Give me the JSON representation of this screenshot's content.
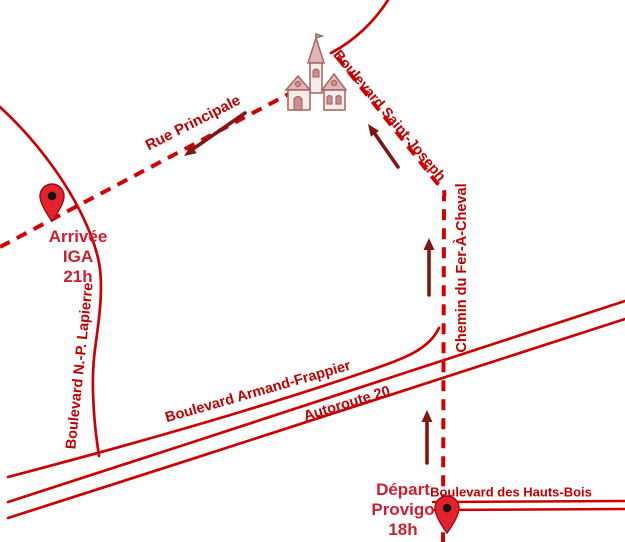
{
  "colors": {
    "background": "#FFFFFF",
    "road_red": "#CC0000",
    "route_red": "#D40000",
    "label_red": "#C00000",
    "marker_text_red": "#CE1F2F",
    "arrow_dark_red": "#801616",
    "pin_red": "#E6212E",
    "pin_stroke": "#8B0E14",
    "pin_dot": "#111111",
    "church_rose": "#A96A6A",
    "church_roof_fill": "#DEB8B8",
    "church_wall_fill": "#F6ECEC",
    "church_window_fill": "#C98F8F"
  },
  "roads": {
    "rue_principale": "Rue Principale",
    "saint_joseph": "Boulevard Saint-Joseph",
    "fer_a_cheval": "Chemin du Fer-À-Cheval",
    "lapierre": "Boulevard N.-P. Lapierre",
    "armand_frappier": "Boulevard Armand-Frappier",
    "autoroute": "Autoroute 20",
    "hauts_bois": "Boulevard des Hauts-Bois"
  },
  "markers": {
    "arrivee": {
      "lines": [
        "Arrivée",
        "IGA",
        "21h"
      ]
    },
    "depart": {
      "lines": [
        "Départ",
        "Provigo",
        "18h"
      ]
    }
  },
  "icons": {
    "church": "church-icon",
    "pin": "map-pin-icon",
    "arrow": "direction-arrow-icon"
  }
}
